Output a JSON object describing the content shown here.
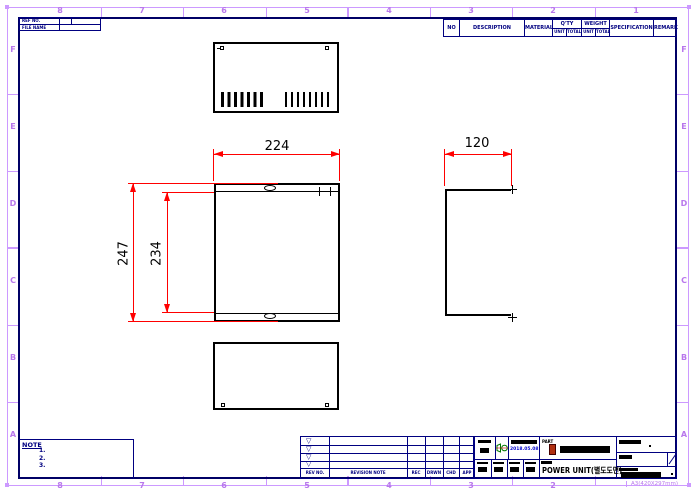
{
  "zones": {
    "columns": [
      "8",
      "7",
      "6",
      "5",
      "4",
      "3",
      "2",
      "1"
    ],
    "rows": [
      "F",
      "E",
      "D",
      "C",
      "B",
      "A"
    ]
  },
  "sheet_size_label": "A3(420X297mm)",
  "ref_table": {
    "row1_label": "REF NO.",
    "row2_label": "FILE NAME"
  },
  "parts_table": {
    "no": "NO",
    "description": "DESCRIPTION",
    "material": "MATERIAL",
    "qty": "Q'TY",
    "weight": "WEIGHT",
    "unit": "UNIT",
    "total": "TOTAL",
    "specification": "SPECIFICATION",
    "remark": "REMARK"
  },
  "dimensions": {
    "front_width": "224",
    "side_width": "120",
    "outer_height": "247",
    "inner_height": "234"
  },
  "note": {
    "title": "NOTE",
    "item1": "1.",
    "item2": "2.",
    "item3": "3."
  },
  "revision_table": {
    "rev_no": "REV NO.",
    "revision_note": "REVISION NOTE",
    "rec": "REC",
    "drwn": "DRWN",
    "chd": "CHD",
    "app": "APP",
    "marker": "▽"
  },
  "title_block": {
    "part_label": "PART",
    "issued_date": "2018.05.08",
    "title": "POWER UNIT(별도도면)"
  },
  "colors": {
    "frame": "#000066",
    "table_line": "#000080",
    "dimension": "#ff0000",
    "zone_text": "#b877ec",
    "date_text": "#0000cc",
    "projection_symbol": "#007700"
  }
}
